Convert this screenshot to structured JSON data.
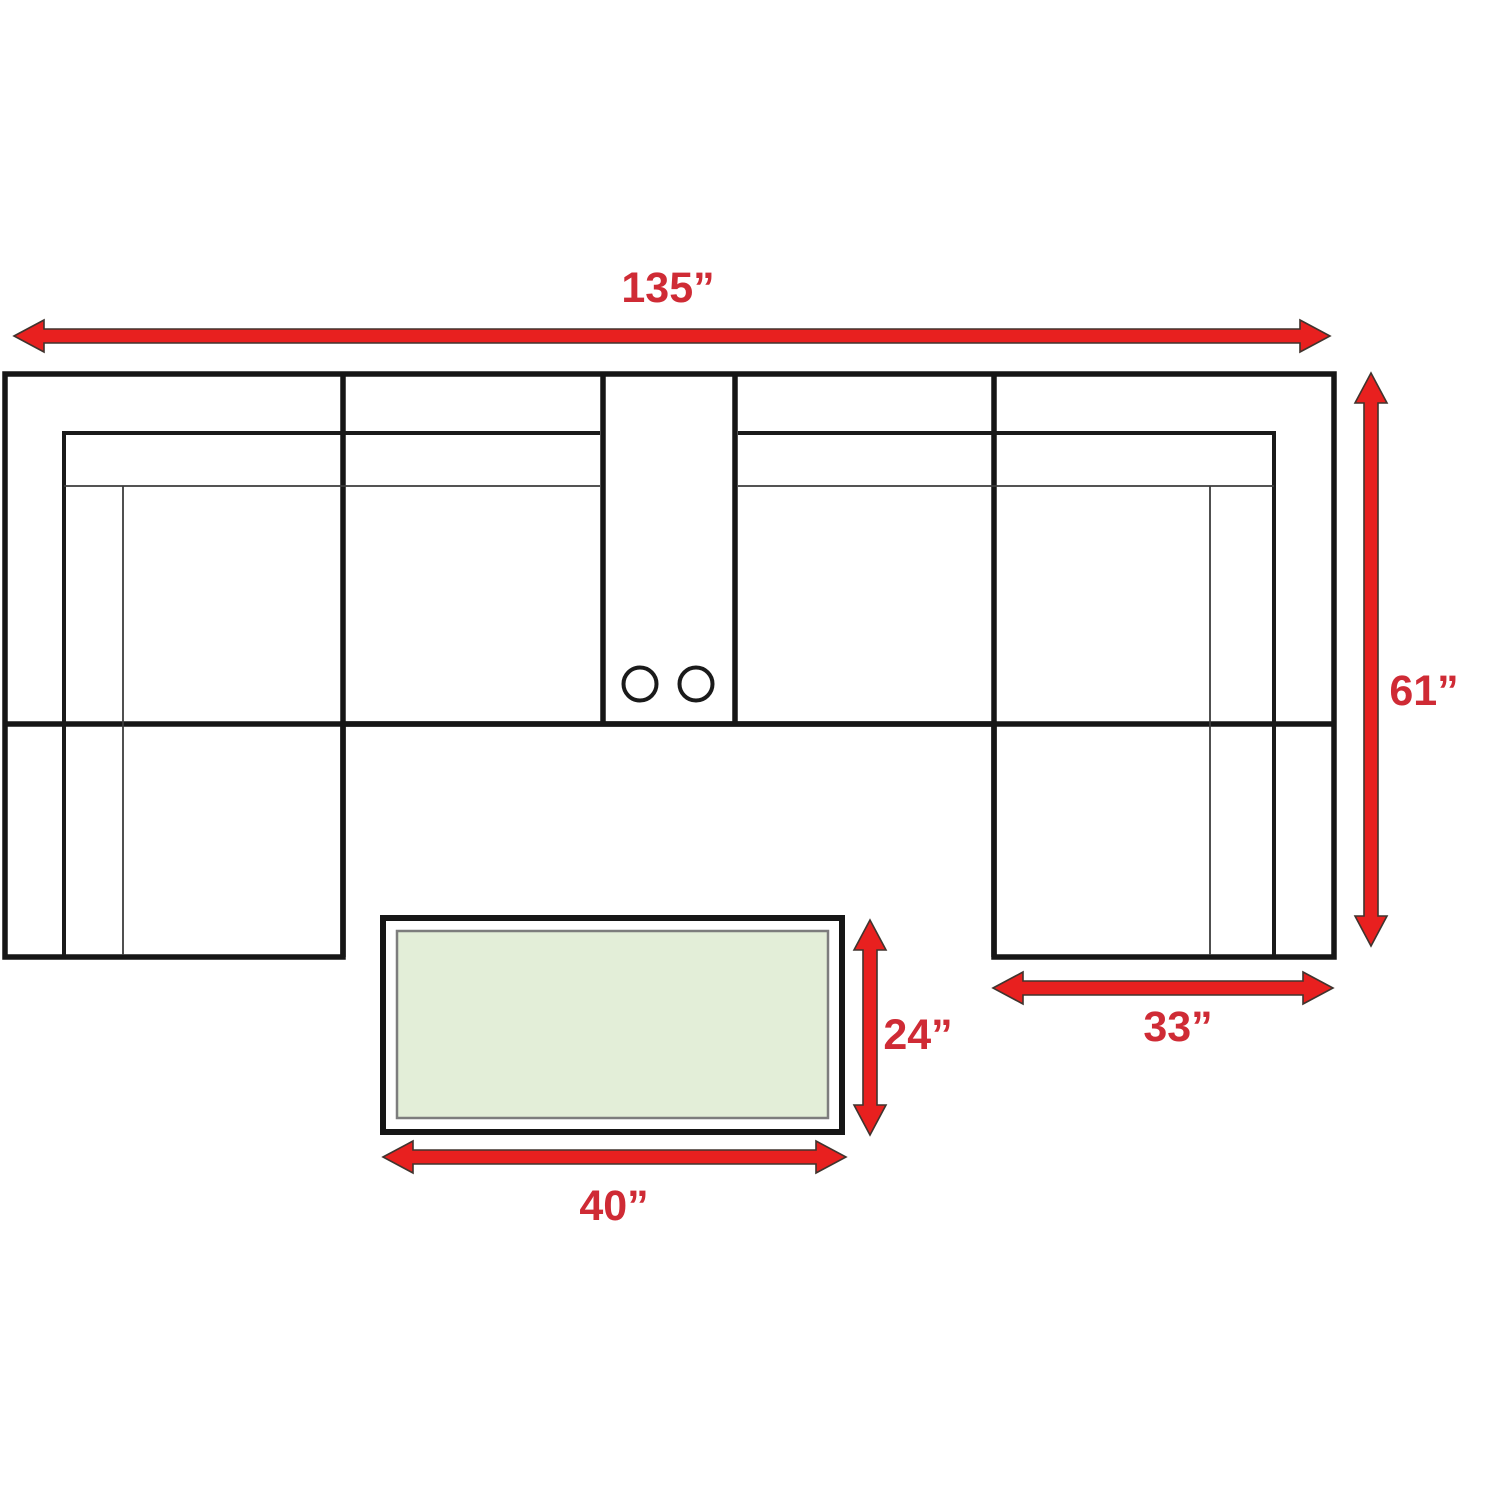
{
  "figure": {
    "title": "Sectional sofa with coffee table dimension diagram"
  },
  "colors": {
    "arrow_red": "#e8201f",
    "arrow_outline": "#40342e",
    "label_red": "#cf2b35",
    "line_black": "#161616",
    "thin_line": "#3c3c3c",
    "table_top_green": "#e3eed8",
    "table_inner_border": "#7d7d7d",
    "background": "#ffffff"
  },
  "dimensions": {
    "overall_width": "135”",
    "overall_depth": "61”",
    "chaise_width": "33”",
    "table_depth": "24”",
    "table_width": "40”"
  }
}
